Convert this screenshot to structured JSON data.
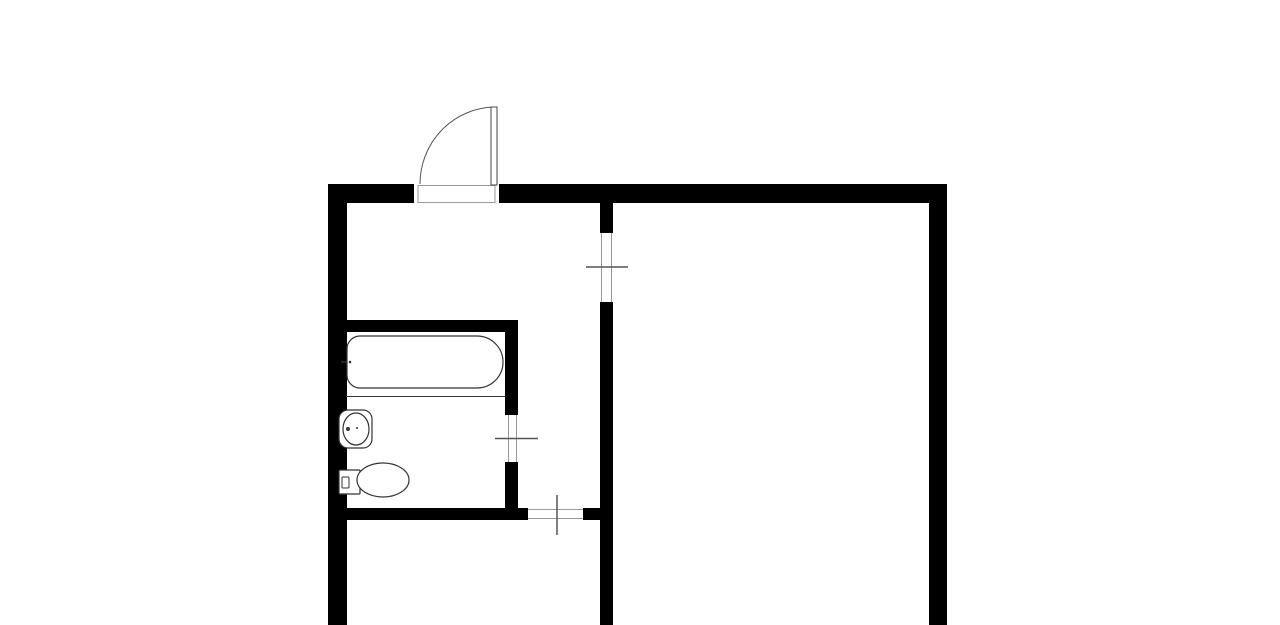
{
  "canvas": {
    "width": 1280,
    "height": 625,
    "background_color": "#ffffff",
    "wall_color": "#000000",
    "fixture_stroke_color": "#333333",
    "tick_stroke_color": "#555555",
    "gap_outline_color": "#999999",
    "door_stroke_color": "#444444"
  },
  "floor_plan": {
    "walls": [
      {
        "name": "wall-outer-left",
        "x": 328,
        "y": 184,
        "w": 19,
        "h": 441
      },
      {
        "name": "wall-outer-top-left-segment",
        "x": 328,
        "y": 184,
        "w": 86,
        "h": 19
      },
      {
        "name": "wall-outer-top-right-segment",
        "x": 499,
        "y": 184,
        "w": 448,
        "h": 19
      },
      {
        "name": "wall-outer-right",
        "x": 929,
        "y": 184,
        "w": 18,
        "h": 441
      },
      {
        "name": "wall-partition-upper",
        "x": 600,
        "y": 203,
        "w": 13,
        "h": 30
      },
      {
        "name": "wall-partition-lower",
        "x": 600,
        "y": 302,
        "w": 13,
        "h": 323
      },
      {
        "name": "wall-bathroom-top",
        "x": 346,
        "y": 320,
        "w": 172,
        "h": 12
      },
      {
        "name": "wall-bathroom-side-upper",
        "x": 505,
        "y": 320,
        "w": 13,
        "h": 95
      },
      {
        "name": "wall-bathroom-side-lower",
        "x": 505,
        "y": 462,
        "w": 13,
        "h": 58
      },
      {
        "name": "wall-bottom-left-segment",
        "x": 346,
        "y": 508,
        "w": 182,
        "h": 12
      },
      {
        "name": "wall-bottom-right-segment",
        "x": 583,
        "y": 508,
        "w": 30,
        "h": 12
      }
    ],
    "outline_rects": [
      {
        "name": "entry-door-threshold",
        "x": 418,
        "y": 185.5,
        "w": 77,
        "h": 17,
        "rx": 0,
        "stroke": "#999999",
        "width": 1
      },
      {
        "name": "entry-door-leaf",
        "x": 491,
        "y": 107,
        "w": 6,
        "h": 78,
        "rx": 0,
        "stroke": "#444444",
        "width": 1
      },
      {
        "name": "sink-counter",
        "x": 339,
        "y": 410,
        "w": 33,
        "h": 38,
        "rx": 9,
        "stroke": "#333333",
        "width": 1.2
      },
      {
        "name": "toilet-tank",
        "x": 339,
        "y": 470,
        "w": 21,
        "h": 24,
        "rx": 1,
        "stroke": "#333333",
        "width": 1.2
      },
      {
        "name": "toilet-tank-button",
        "x": 342,
        "y": 477,
        "w": 7,
        "h": 11,
        "rx": 1,
        "stroke": "#333333",
        "width": 1
      }
    ],
    "lines": [
      {
        "name": "partition-doorway-jamb-left",
        "x1": 601.5,
        "y1": 233,
        "x2": 601.5,
        "y2": 302,
        "stroke": "#999999",
        "width": 1
      },
      {
        "name": "partition-doorway-jamb-right",
        "x1": 611.5,
        "y1": 233,
        "x2": 611.5,
        "y2": 302,
        "stroke": "#999999",
        "width": 1
      },
      {
        "name": "partition-doorway-tick",
        "x1": 586,
        "y1": 267,
        "x2": 628,
        "y2": 267,
        "stroke": "#555555",
        "width": 1.5
      },
      {
        "name": "bathroom-doorway-jamb-left",
        "x1": 508.5,
        "y1": 415,
        "x2": 508.5,
        "y2": 462,
        "stroke": "#999999",
        "width": 1
      },
      {
        "name": "bathroom-doorway-jamb-right",
        "x1": 516.5,
        "y1": 415,
        "x2": 516.5,
        "y2": 462,
        "stroke": "#999999",
        "width": 1
      },
      {
        "name": "bathroom-doorway-tick",
        "x1": 495,
        "y1": 438.5,
        "x2": 538,
        "y2": 438.5,
        "stroke": "#555555",
        "width": 1.5
      },
      {
        "name": "bottom-doorway-jamb-top",
        "x1": 528,
        "y1": 509.5,
        "x2": 583,
        "y2": 509.5,
        "stroke": "#999999",
        "width": 1
      },
      {
        "name": "bottom-doorway-jamb-bottom",
        "x1": 528,
        "y1": 518.5,
        "x2": 583,
        "y2": 518.5,
        "stroke": "#999999",
        "width": 1
      },
      {
        "name": "bottom-doorway-tick",
        "x1": 557,
        "y1": 495,
        "x2": 557,
        "y2": 535,
        "stroke": "#555555",
        "width": 1.5
      },
      {
        "name": "bathtub-divider",
        "x1": 346,
        "y1": 396.5,
        "x2": 505,
        "y2": 396.5,
        "stroke": "#333333",
        "width": 1
      },
      {
        "name": "bathtub-faucet-tick",
        "x1": 341,
        "y1": 362,
        "x2": 352,
        "y2": 362,
        "stroke": "#333333",
        "width": 1.5
      }
    ],
    "paths": [
      {
        "name": "entry-door-arc",
        "d": "M 494 107 A 76 77 0 0 0 420 184",
        "stroke": "#555555",
        "width": 1,
        "fill": "none"
      },
      {
        "name": "bathtub",
        "d": "M 360 336 L 477 336 A 26 26 0 0 1 477 388 L 360 388 A 13 13 0 0 1 347 375 L 347 349 A 13 13 0 0 1 360 336 Z",
        "stroke": "#333333",
        "width": 1.2,
        "fill": "#ffffff"
      }
    ],
    "ellipses": [
      {
        "name": "sink-basin",
        "cx": 356,
        "cy": 429,
        "rx": 13,
        "ry": 16,
        "stroke": "#333333",
        "width": 1.2
      },
      {
        "name": "toilet-bowl",
        "cx": 383,
        "cy": 480,
        "rx": 26,
        "ry": 17,
        "stroke": "#333333",
        "width": 1.2
      }
    ],
    "dots": [
      {
        "name": "sink-faucet-dot",
        "cx": 348,
        "cy": 429,
        "r": 2,
        "fill": "#333333"
      },
      {
        "name": "sink-drain-dot",
        "cx": 357,
        "cy": 428,
        "r": 1,
        "fill": "#333333"
      },
      {
        "name": "bathtub-faucet-dot",
        "cx": 350,
        "cy": 362,
        "r": 1.3,
        "fill": "#333333"
      }
    ]
  }
}
